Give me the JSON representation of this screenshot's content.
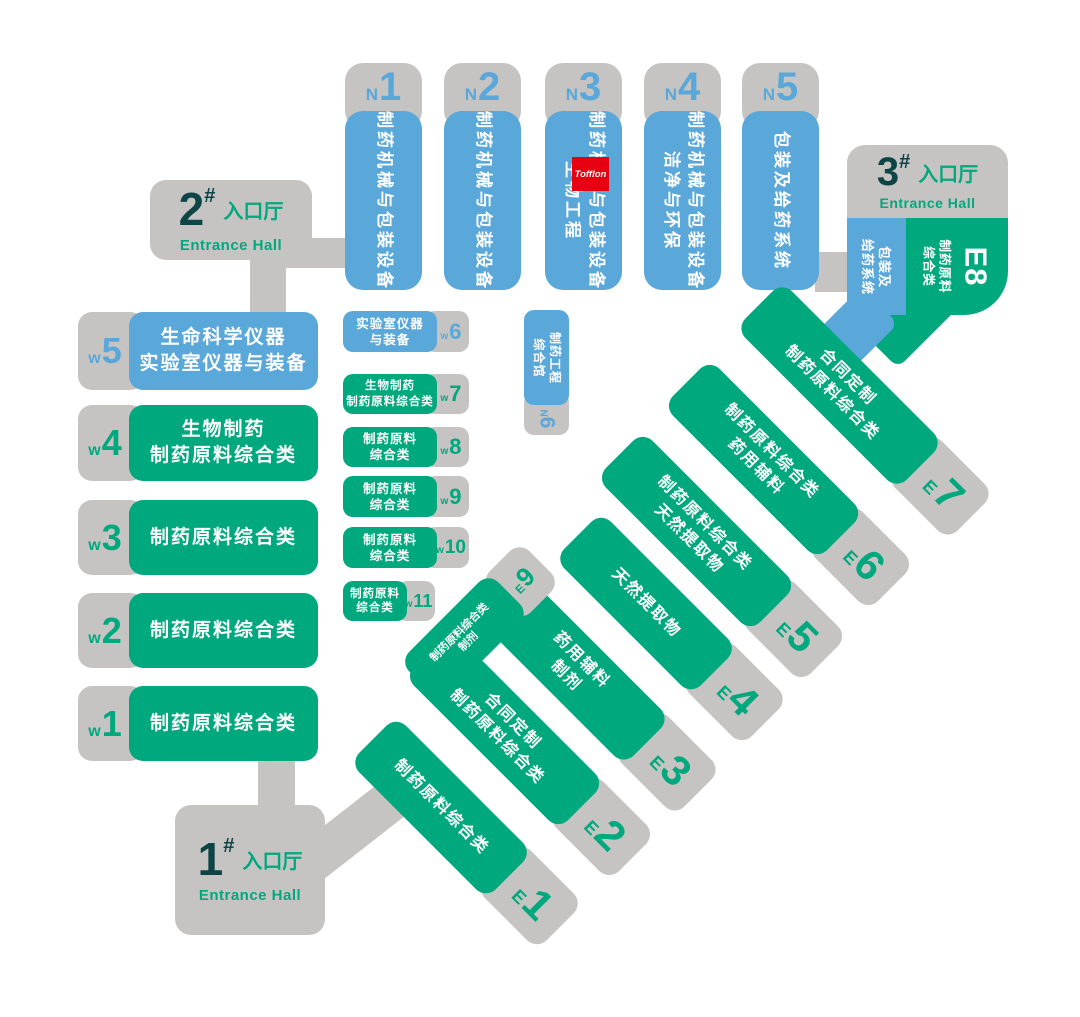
{
  "palette": {
    "blue": "#5aa7da",
    "green": "#00a87d",
    "gray": "#c6c4c2",
    "dark_teal": "#0d4547",
    "red": "#e60012",
    "white": "#ffffff"
  },
  "entrances": {
    "e1": {
      "num": "1",
      "hash": "#",
      "cn": "入口厅",
      "en": "Entrance Hall"
    },
    "e2": {
      "num": "2",
      "hash": "#",
      "cn": "入口厅",
      "en": "Entrance Hall"
    },
    "e3": {
      "num": "3",
      "hash": "#",
      "cn": "入口厅",
      "en": "Entrance Hall"
    }
  },
  "halls": {
    "n1": {
      "prefix": "N",
      "num": "1",
      "lines": [
        "制药机械与包装设备"
      ]
    },
    "n2": {
      "prefix": "N",
      "num": "2",
      "lines": [
        "制药机械与包装设备"
      ]
    },
    "n3": {
      "prefix": "N",
      "num": "3",
      "lines": [
        "制药机械与包装设备",
        "生物工程"
      ]
    },
    "n4": {
      "prefix": "N",
      "num": "4",
      "lines": [
        "制药机械与包装设备",
        "洁净与环保"
      ]
    },
    "n5": {
      "prefix": "N",
      "num": "5",
      "lines": [
        "包装及给药系统"
      ]
    },
    "n6": {
      "prefix": "N",
      "num": "6",
      "lines": [
        "制药工程",
        "综合馆"
      ]
    },
    "w1": {
      "prefix": "w",
      "num": "1",
      "lines": [
        "制药原料综合类"
      ]
    },
    "w2": {
      "prefix": "w",
      "num": "2",
      "lines": [
        "制药原料综合类"
      ]
    },
    "w3": {
      "prefix": "w",
      "num": "3",
      "lines": [
        "制药原料综合类"
      ]
    },
    "w4": {
      "prefix": "w",
      "num": "4",
      "lines": [
        "生物制药",
        "制药原料综合类"
      ]
    },
    "w5": {
      "prefix": "w",
      "num": "5",
      "lines": [
        "生命科学仪器",
        "实验室仪器与装备"
      ]
    },
    "w6": {
      "prefix": "w",
      "num": "6",
      "lines": [
        "实验室仪器",
        "与装备"
      ]
    },
    "w7": {
      "prefix": "w",
      "num": "7",
      "lines": [
        "生物制药",
        "制药原料综合类"
      ]
    },
    "w8": {
      "prefix": "w",
      "num": "8",
      "lines": [
        "制药原料",
        "综合类"
      ]
    },
    "w9": {
      "prefix": "w",
      "num": "9",
      "lines": [
        "制药原料",
        "综合类"
      ]
    },
    "w10": {
      "prefix": "w",
      "num": "10",
      "lines": [
        "制药原料",
        "综合类"
      ]
    },
    "w11": {
      "prefix": "w",
      "num": "11",
      "lines": [
        "制药原料",
        "综合类"
      ]
    },
    "e1": {
      "prefix": "E",
      "num": "1",
      "lines": [
        "制药原料综合类"
      ]
    },
    "e2": {
      "prefix": "E",
      "num": "2",
      "lines": [
        "合同定制",
        "制药原料综合类"
      ]
    },
    "e3": {
      "prefix": "E",
      "num": "3",
      "lines": [
        "药用辅料",
        "制剂"
      ]
    },
    "e4": {
      "prefix": "E",
      "num": "4",
      "lines": [
        "天然提取物"
      ]
    },
    "e5": {
      "prefix": "E",
      "num": "5",
      "lines": [
        "制药原料综合类",
        "天然提取物"
      ]
    },
    "e6": {
      "prefix": "E",
      "num": "6",
      "lines": [
        "制药原料综合类",
        "药用辅料"
      ]
    },
    "e7": {
      "prefix": "E",
      "num": "7",
      "lines": [
        "合同定制",
        "制药原料综合类"
      ]
    },
    "e8": {
      "prefix": "E",
      "num": "8",
      "green_lines": [
        "制药原料",
        "综合类"
      ],
      "blue_lines": [
        "包装及",
        "给药系统"
      ]
    },
    "e9": {
      "prefix": "E",
      "num": "9",
      "lines": [
        "制药原料综合类",
        "制剂"
      ]
    }
  },
  "logo": {
    "text": "Tofflon"
  }
}
